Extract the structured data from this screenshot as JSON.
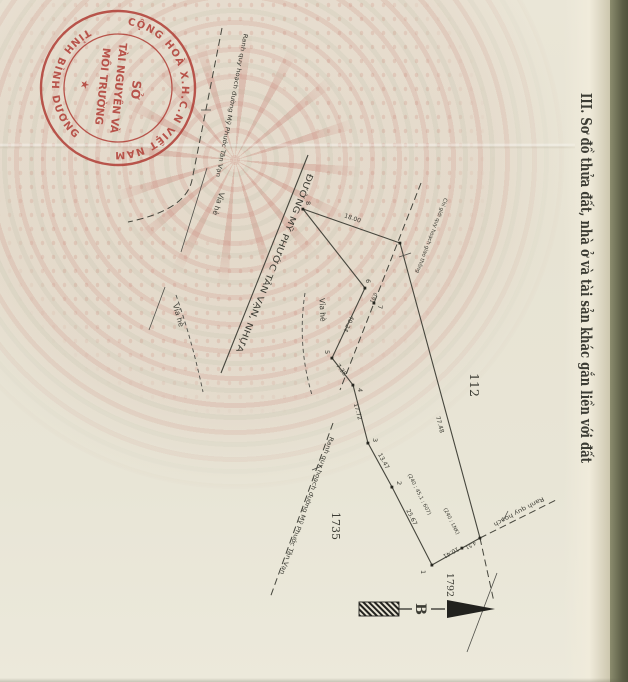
{
  "document": {
    "section_title": "III. Sơ đồ thửa đất, nhà ở và tài sản khác gắn liền với đất"
  },
  "stamp": {
    "arc_top": "CỘNG HOÀ X.H.C.N VIỆT NAM",
    "arc_bottom": "TỈNH BÌNH DƯƠNG",
    "line1": "SỞ",
    "line2": "TÀI NGUYÊN VÀ",
    "line3": "MÔI TRƯỜNG",
    "star": "★",
    "color": "#b2423a"
  },
  "map": {
    "road_label": "ĐƯỜNG MỸ PHƯỚC TÂN VẠN, NHỰA",
    "red_line_label": "Chỉ giới quy hoạch giao thông",
    "planning_boundary_label_1": "Ranh quy hoạch đường Mỹ Phước Tân Vạn",
    "planning_boundary_label_2": "Ranh quy hoạch đường Mỹ Phước Tân Vạn",
    "planning_boundary_label_3": "Ranh quy hoạch",
    "sidewalk_label_1": "Vỉa hè",
    "sidewalk_label_2": "Vỉa hè",
    "sidewalk_label_3": "Vỉa hè",
    "north_label": "B",
    "parcels": {
      "east": "112",
      "road": "1735",
      "south": "1792"
    },
    "dimensions": {
      "top": "18.00",
      "front": "40.24",
      "seg_5_4": "7.38",
      "seg_4_3": "17.72",
      "seg_3_2": "13.47",
      "seg_2_1": "25.67",
      "bottom": "10.41",
      "bottom_small": "4.51",
      "long_edge": "77.48",
      "tiny": "0.91"
    },
    "points": {
      "p1": "1",
      "p2": "2",
      "p3": "3",
      "p4": "4",
      "p5": "5",
      "p6": "6",
      "p7": "7",
      "p8": "8"
    },
    "annotations": {
      "area_note_1": "(240 ; 45,1 ; 607)",
      "area_note_2": "(240 ; LNK)"
    }
  }
}
